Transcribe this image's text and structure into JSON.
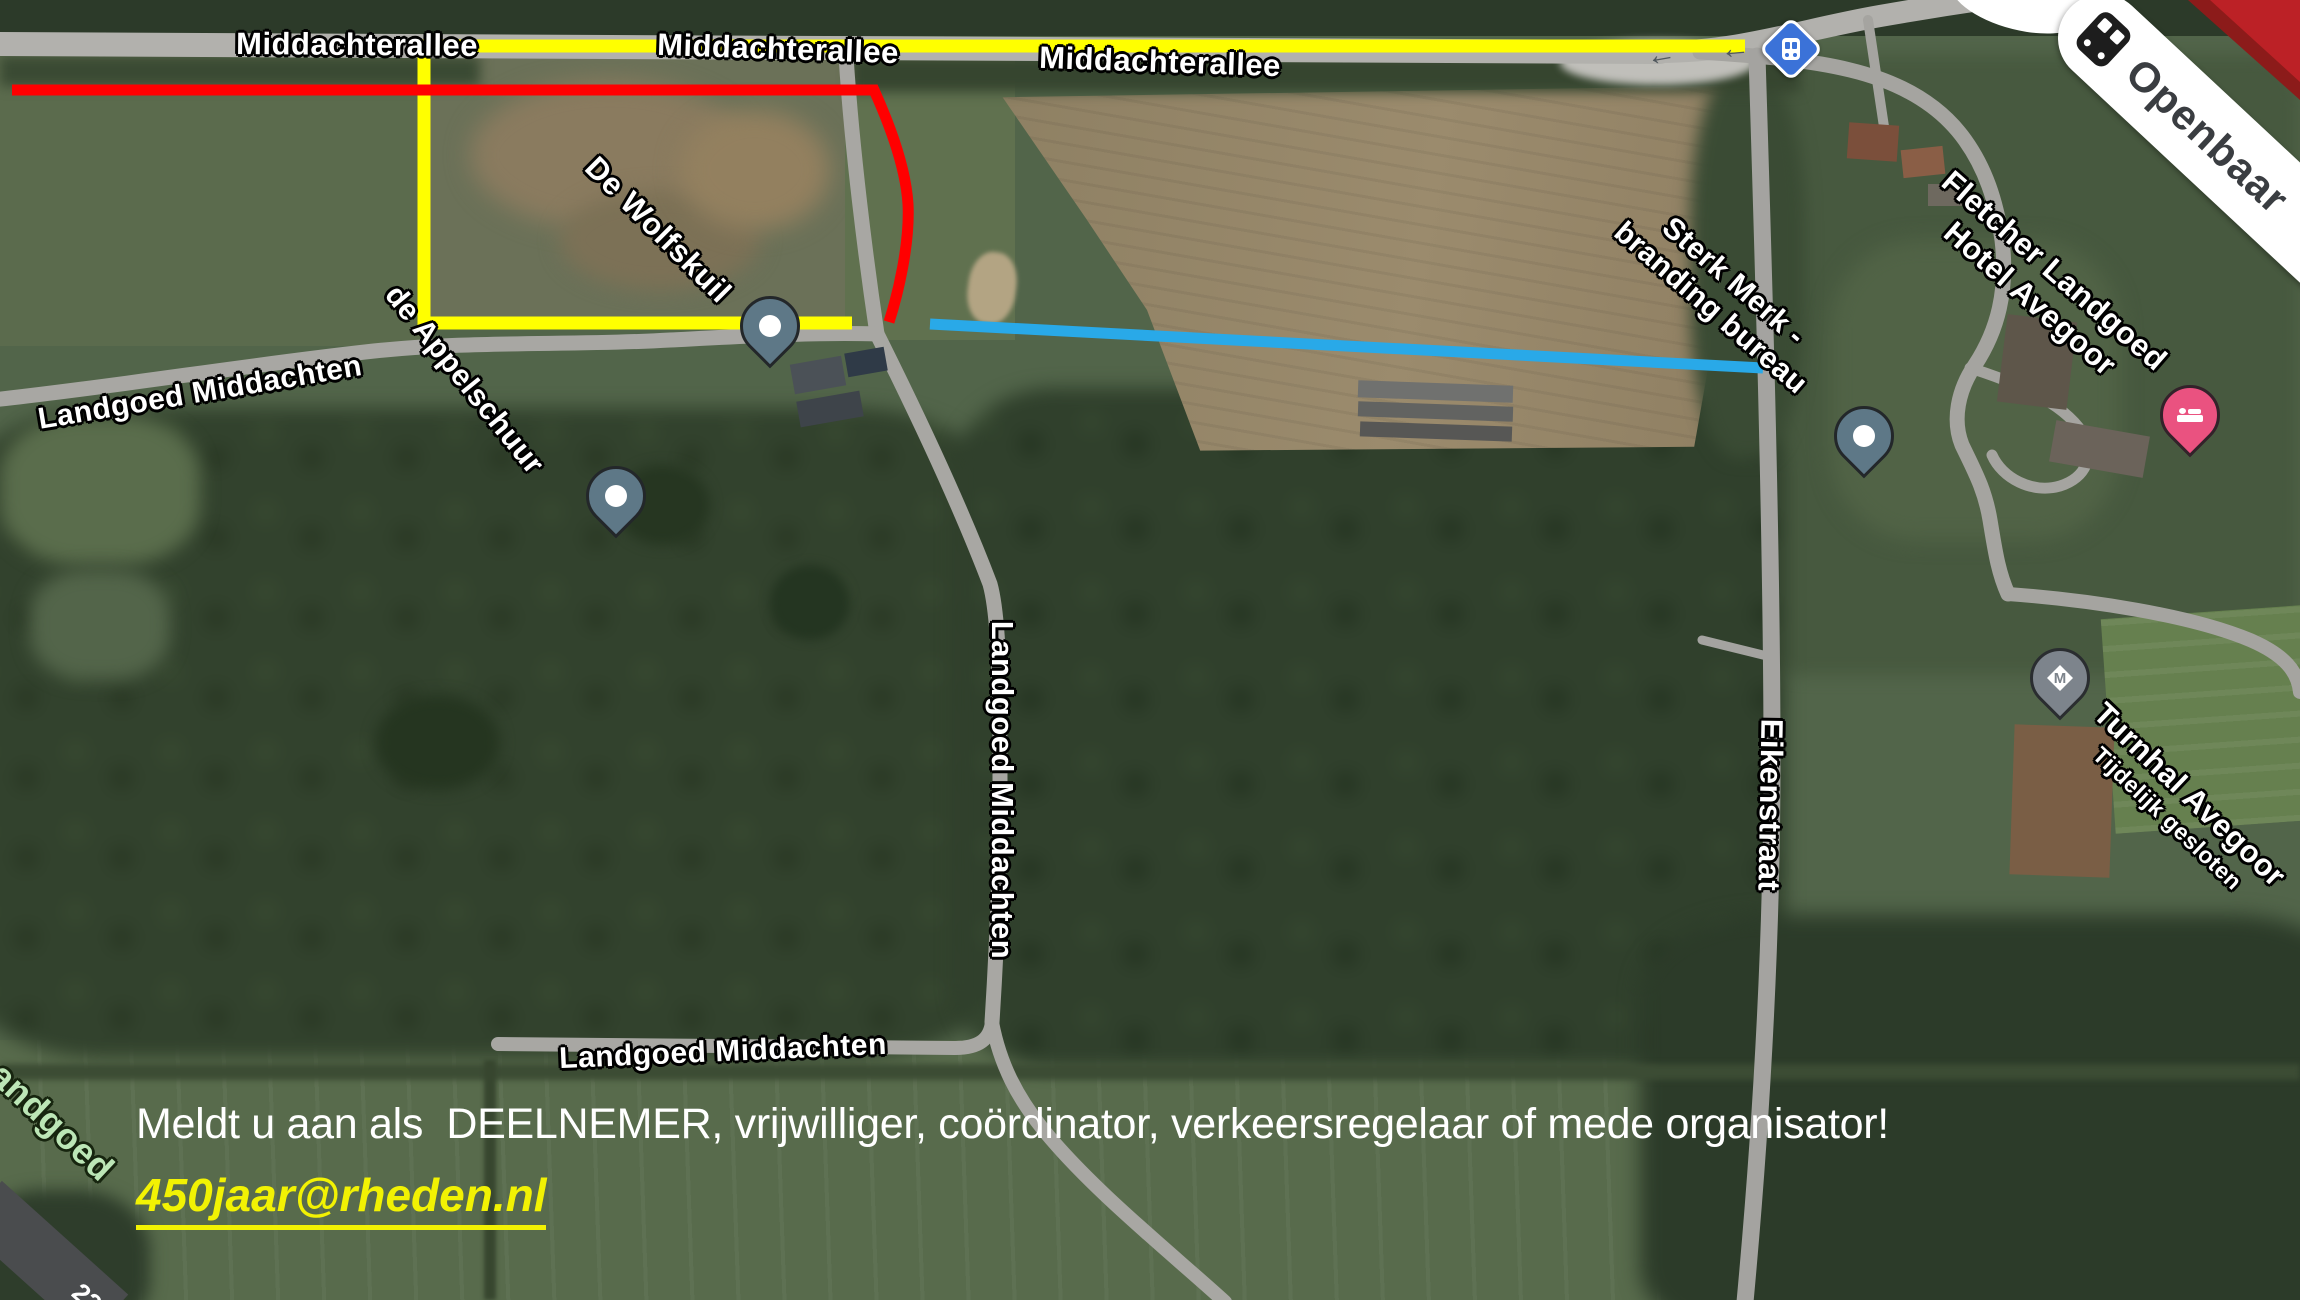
{
  "map_labels": {
    "middachterallee_west": "Middachterallee",
    "middachterallee_center": "Middachterallee",
    "middachterallee_east": "Middachterallee",
    "de_wolfskuil": "De Wolfskuil",
    "de_appelschuur": "de Appelschuur",
    "landgoed_middachten_west": "Landgoed Middachten",
    "landgoed_middachten_road": "Landgoed Middachten",
    "landgoed_middachten_south": "Landgoed Middachten",
    "eikenstraat": "Eikenstraat",
    "sterk_merk_line1": "Sterk Merk -",
    "sterk_merk_line2": "branding bureau",
    "fletcher_line1": "Fletcher Landgoed",
    "fletcher_line2": "Hotel Avegoor",
    "turnhal_line1": "Turnhal Avegoor",
    "turnhal_line2": "Tijdelijk gesloten",
    "openbaar": "Openbaar",
    "estate_partial": "andgoed",
    "road_number_partial": "22"
  },
  "markers": {
    "museum_pin_glyph": "M"
  },
  "annotations": {
    "yellow_route_color": "#ffff00",
    "red_route_color": "#ff0000",
    "blue_route_color": "#29a9e8"
  },
  "cta": {
    "line1": "Meldt u aan als  DEELNEMER, vrijwilliger, coördinator, verkeersregelaar of mede organisator!",
    "email": "450jaar@rheden.nl"
  }
}
